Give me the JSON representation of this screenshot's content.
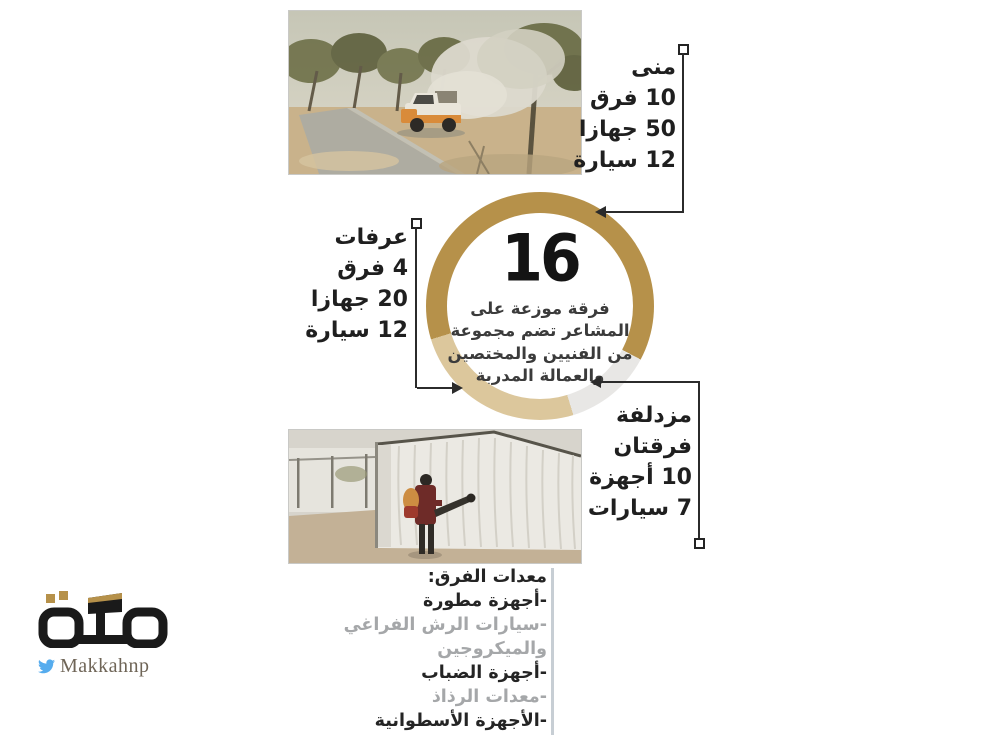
{
  "infographic": {
    "locations": {
      "mina": {
        "title": "منى",
        "stats": [
          "10 فرق",
          "50 جهازا",
          "12 سيارة"
        ]
      },
      "arafat": {
        "title": "عرفات",
        "stats": [
          "4 فرق",
          "20 جهازا",
          "12 سيارة"
        ]
      },
      "muzdalifah": {
        "title": "مزدلفة",
        "stats": [
          "فرقتان",
          "10 أجهزة",
          "7 سيارات"
        ]
      }
    },
    "center": {
      "number": "16",
      "lines": [
        "فرقة موزعة على",
        "المشاعر تضم مجموعة",
        "من الفنيين والمختصين",
        "والعمالة المدربة"
      ]
    },
    "equipment": {
      "header": "معدات الفرق:",
      "items": [
        {
          "text": "-أجهزة مطورة",
          "tone": "dark"
        },
        {
          "text": "-سيارات الرش الفراغي",
          "tone": "gray"
        },
        {
          "text": "والميكروجين",
          "tone": "gray"
        },
        {
          "text": "-أجهزة الضباب",
          "tone": "dark"
        },
        {
          "text": "-معدات الرذاذ",
          "tone": "gray"
        },
        {
          "text": "-الأجهزة الأسطوانية",
          "tone": "dark"
        }
      ]
    },
    "logo": {
      "wordmark": "مكة",
      "handle": "Makkahnp",
      "icon": "twitter-bird-icon"
    }
  },
  "photos": {
    "top": {
      "depicts": "pickup truck releasing pesticide fog among park trees"
    },
    "bottom": {
      "depicts": "worker with backpack fogger spraying a white tent"
    }
  },
  "chart_data": {
    "type": "donut",
    "title": "16 فرقة موزعة على المشاعر",
    "total": 16,
    "center_number": 16,
    "segments": [
      {
        "label": "منى",
        "value": 10,
        "color": "#b6914a"
      },
      {
        "label": "مزدلفة",
        "value": 2,
        "color": "#e8e7e5"
      },
      {
        "label": "عرفات",
        "value": 4,
        "color": "#dcc79c"
      }
    ],
    "start_angle_deg": 253,
    "ring": {
      "outer_diameter": 228,
      "thickness": 21
    },
    "legend_position": "callout-arrows"
  },
  "colors": {
    "gold": "#b6914a",
    "beige": "#dcc79c",
    "light_gray_segment": "#e8e7e5",
    "text_dark": "#1f1f1f",
    "text_gray": "#a5a7a9",
    "connector": "#2b2b2b",
    "twitter_blue": "#55acee",
    "logo_gold": "#b6914a"
  }
}
